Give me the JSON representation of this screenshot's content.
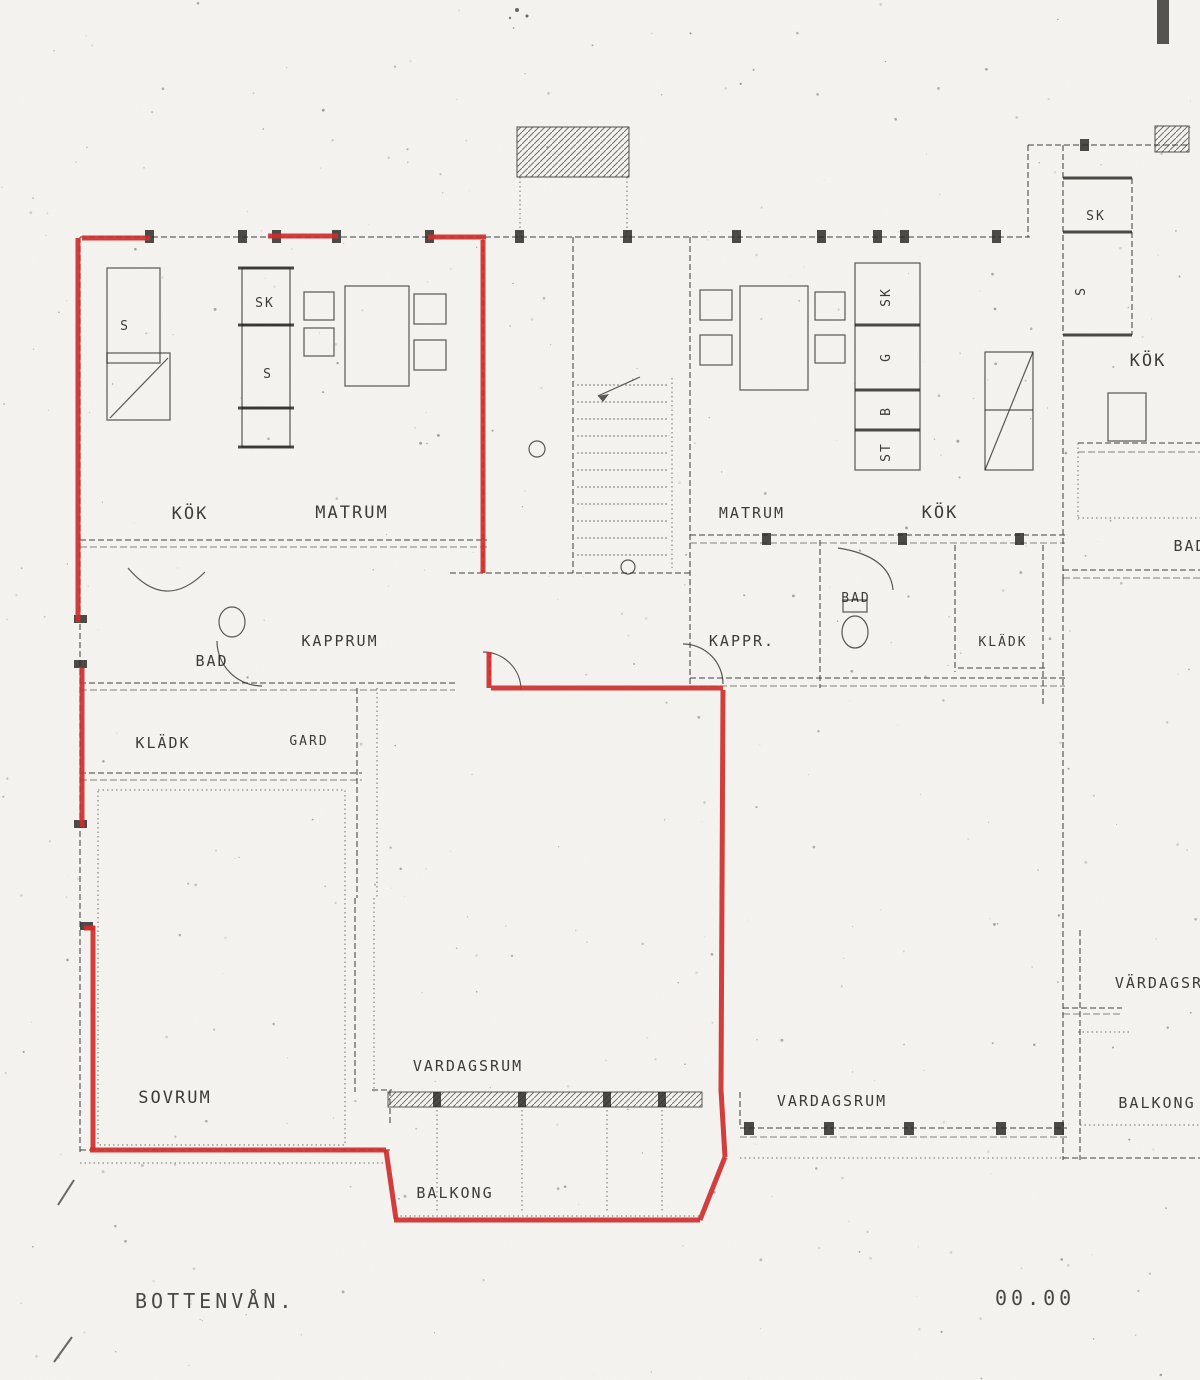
{
  "colors": {
    "paper": "#f6f5f1",
    "ink": "#35322c",
    "outline_red": "#ce2f2b"
  },
  "plan": {
    "floor_title": "BOTTENVÅN.",
    "elevation_mark": "00.00",
    "rooms": {
      "kok_left": "KÖK",
      "matrum_left": "MATRUM",
      "bad_left": "BAD",
      "kapprum_left": "KAPPRUM",
      "kladk_left": "KLÄDK",
      "gard_left": "GARD",
      "sovrum_left": "SOVRUM",
      "vardagsrum_left": "VARDAGSRUM",
      "balkong_left": "BALKONG",
      "matrum_mid": "MATRUM",
      "kok_mid": "KÖK",
      "kappr_mid": "KAPPR.",
      "bad_mid": "BAD",
      "kladk_mid": "KLÄDK",
      "vardagsrum_mid": "VARDAGSRUM",
      "kok_right": "KÖK",
      "bad_right": "BAD",
      "vardagsrum_right": "VÄRDAGSRUM",
      "balkong_right": "BALKONG",
      "closet_s_1": "S",
      "closet_sk_1": "SK",
      "closet_s_2": "S",
      "closet_sk_mid": "SK",
      "closet_g_mid": "G",
      "closet_b_mid": "B",
      "closet_st_mid": "ST",
      "closet_sk_right": "SK",
      "closet_s_right": "S"
    }
  }
}
